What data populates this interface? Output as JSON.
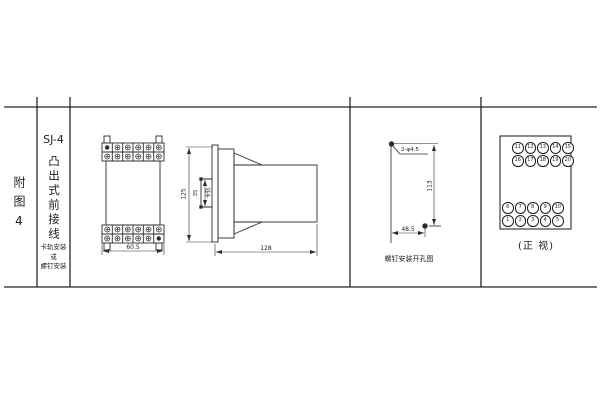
{
  "sidebar": {
    "figure_label": "附图4",
    "model": "SJ-4",
    "type_label": "凸出式前接线",
    "mount_line1": "卡轨安装",
    "mount_line2": "或",
    "mount_line3": "螺钉安装"
  },
  "front_view": {
    "width_dim": "60.5"
  },
  "side_view": {
    "height_dim": "125",
    "slot_dim": "35",
    "slot_label": "卡轨",
    "depth_dim": "128"
  },
  "drill_view": {
    "holes_label": "2-φ4.5",
    "vertical_dim": "113",
    "horizontal_dim": "48.5",
    "caption": "螺钉安装开孔图"
  },
  "terminal_panel": {
    "caption": "(正 视)",
    "rows": [
      [
        "11",
        "12",
        "13",
        "14",
        "15"
      ],
      [
        "16",
        "17",
        "18",
        "19",
        "20"
      ],
      [
        "6",
        "7",
        "8",
        "9",
        "10"
      ],
      [
        "1",
        "2",
        "3",
        "4",
        "5"
      ]
    ]
  },
  "colors": {
    "line": "#2b2b2b",
    "background": "#ffffff"
  }
}
